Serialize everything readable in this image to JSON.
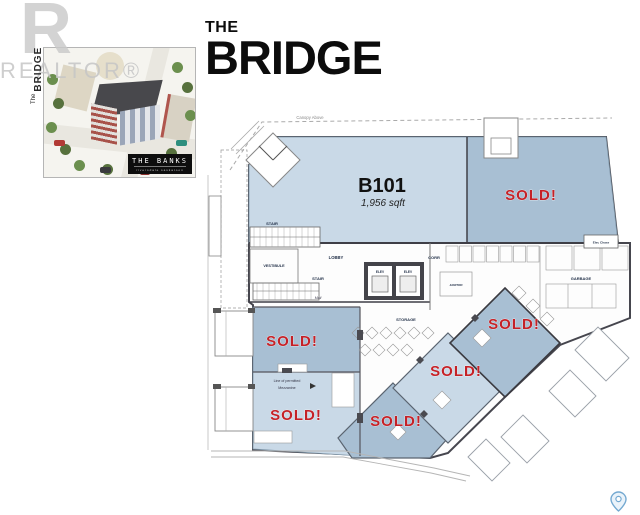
{
  "branding": {
    "watermark_r": "R",
    "watermark_realtor": "REALTOR®",
    "inset_vertical_the": "The",
    "inset_vertical_name": "BRIDGE",
    "inset_badge_title": "THE BANKS",
    "inset_badge_subtitle": "riversdale saskatoon"
  },
  "header": {
    "title_line1": "THE",
    "title_line2": "BRIDGE"
  },
  "floorplan": {
    "canopy_label": "Canopy Above",
    "unit": {
      "id": "B101",
      "area": "1,956 sqft"
    },
    "sold_label": "SOLD!",
    "rooms": {
      "vestibule": "VESTIBULE",
      "lobby": "LOBBY",
      "corridor": "CORR",
      "stair": "STAIR",
      "mail": "Mail",
      "elevator": "ELEV",
      "storage": "STORAGE",
      "garbage": "GARBAGE",
      "janitor": "JANITOR",
      "elec_chase": "Elec Chase",
      "mezzanine_line1": "Line of permitted",
      "mezzanine_line2": "Mezzanine"
    }
  },
  "colors": {
    "unit_available": "#c9d9e7",
    "unit_sold": "#a8bfd3",
    "sold_red": "#c42127",
    "wall": "#3f3f47",
    "pin_blue": "#74a9d1"
  }
}
